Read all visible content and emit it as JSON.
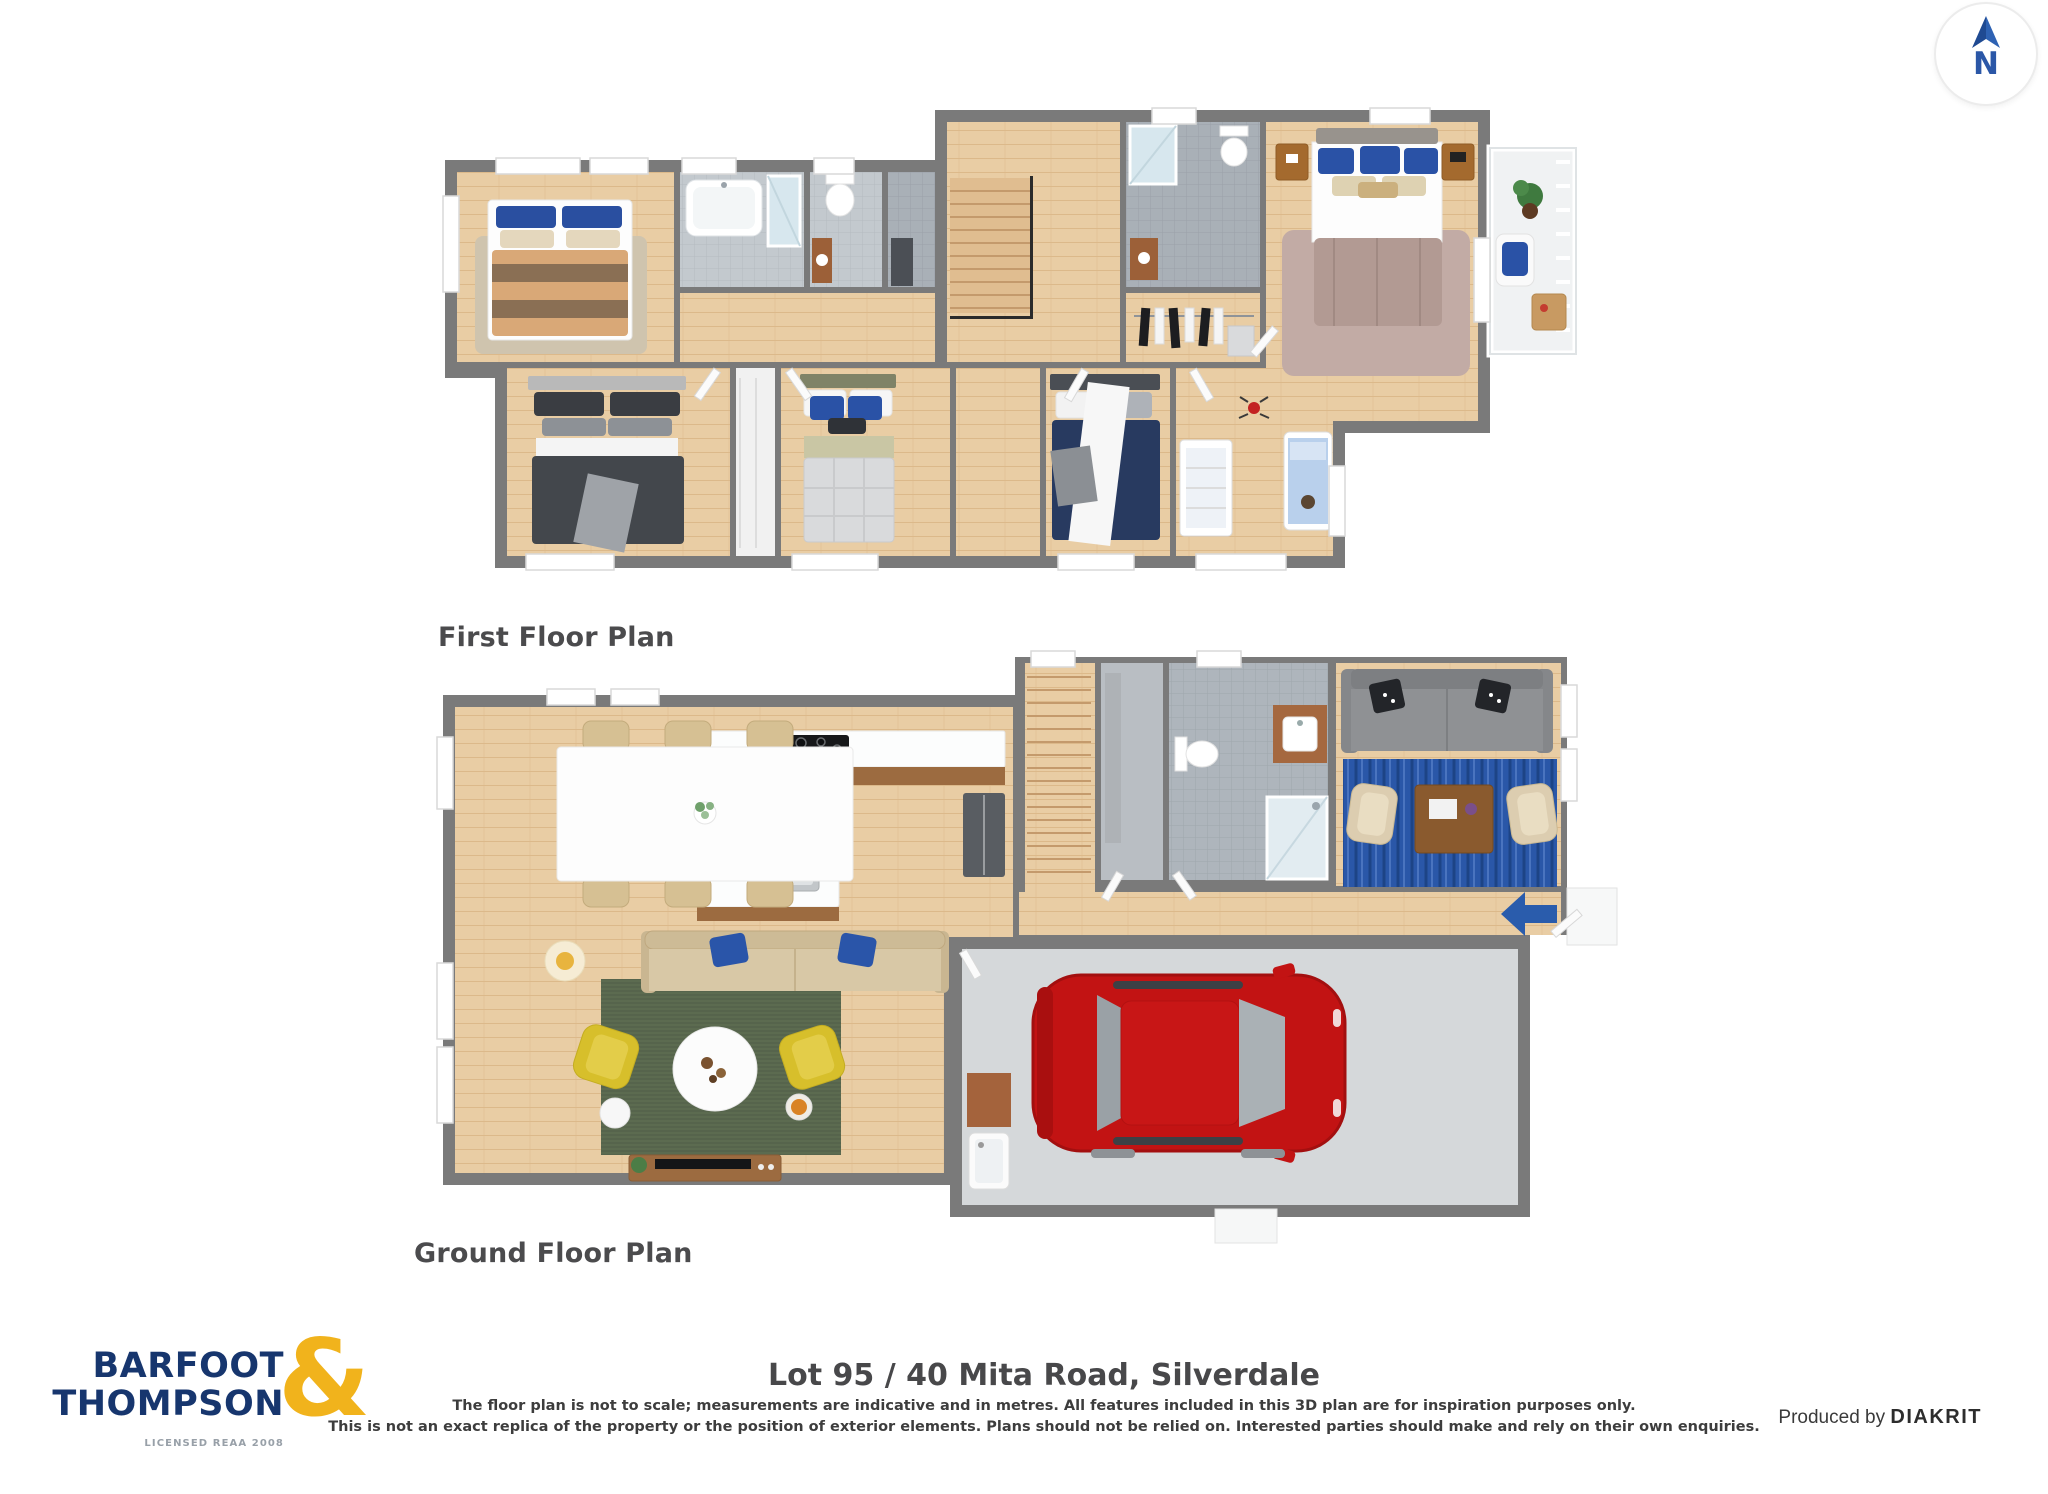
{
  "compass": {
    "letter": "N"
  },
  "plans": {
    "first": {
      "label": "First Floor Plan"
    },
    "ground": {
      "label": "Ground Floor Plan"
    }
  },
  "footer": {
    "logo_line1": "BARFOOT",
    "logo_line2": "THOMPSON",
    "logo_ampersand": "&",
    "logo_tagline": "LICENSED REAA 2008",
    "address_title": "Lot 95 / 40 Mita Road, Silverdale",
    "disclaimer_line1": "The floor plan is not to scale; measurements are indicative and in metres. All features included in this 3D plan are for inspiration purposes only.",
    "disclaimer_line2": "This is not an exact replica of the property or the position of exterior elements. Plans should not be relied on. Interested parties should make and rely on their own enquiries.",
    "produced_by_label": "Produced by",
    "producer_name": "DIAKRIT"
  },
  "colors": {
    "logo_navy": "#17366E",
    "logo_gold": "#F1B31C",
    "compass_blue": "#2B57A7",
    "heading_gray": "#4B4B4D",
    "wall_gray": "#7A7A7A",
    "wood_floor": "#E9CDA4",
    "tile_gray": "#AEB5BC",
    "rug_green": "#5C6B50",
    "rug_blue": "#2A57A8",
    "car_red": "#C21313",
    "armchair_yellow": "#D7BF2B"
  }
}
